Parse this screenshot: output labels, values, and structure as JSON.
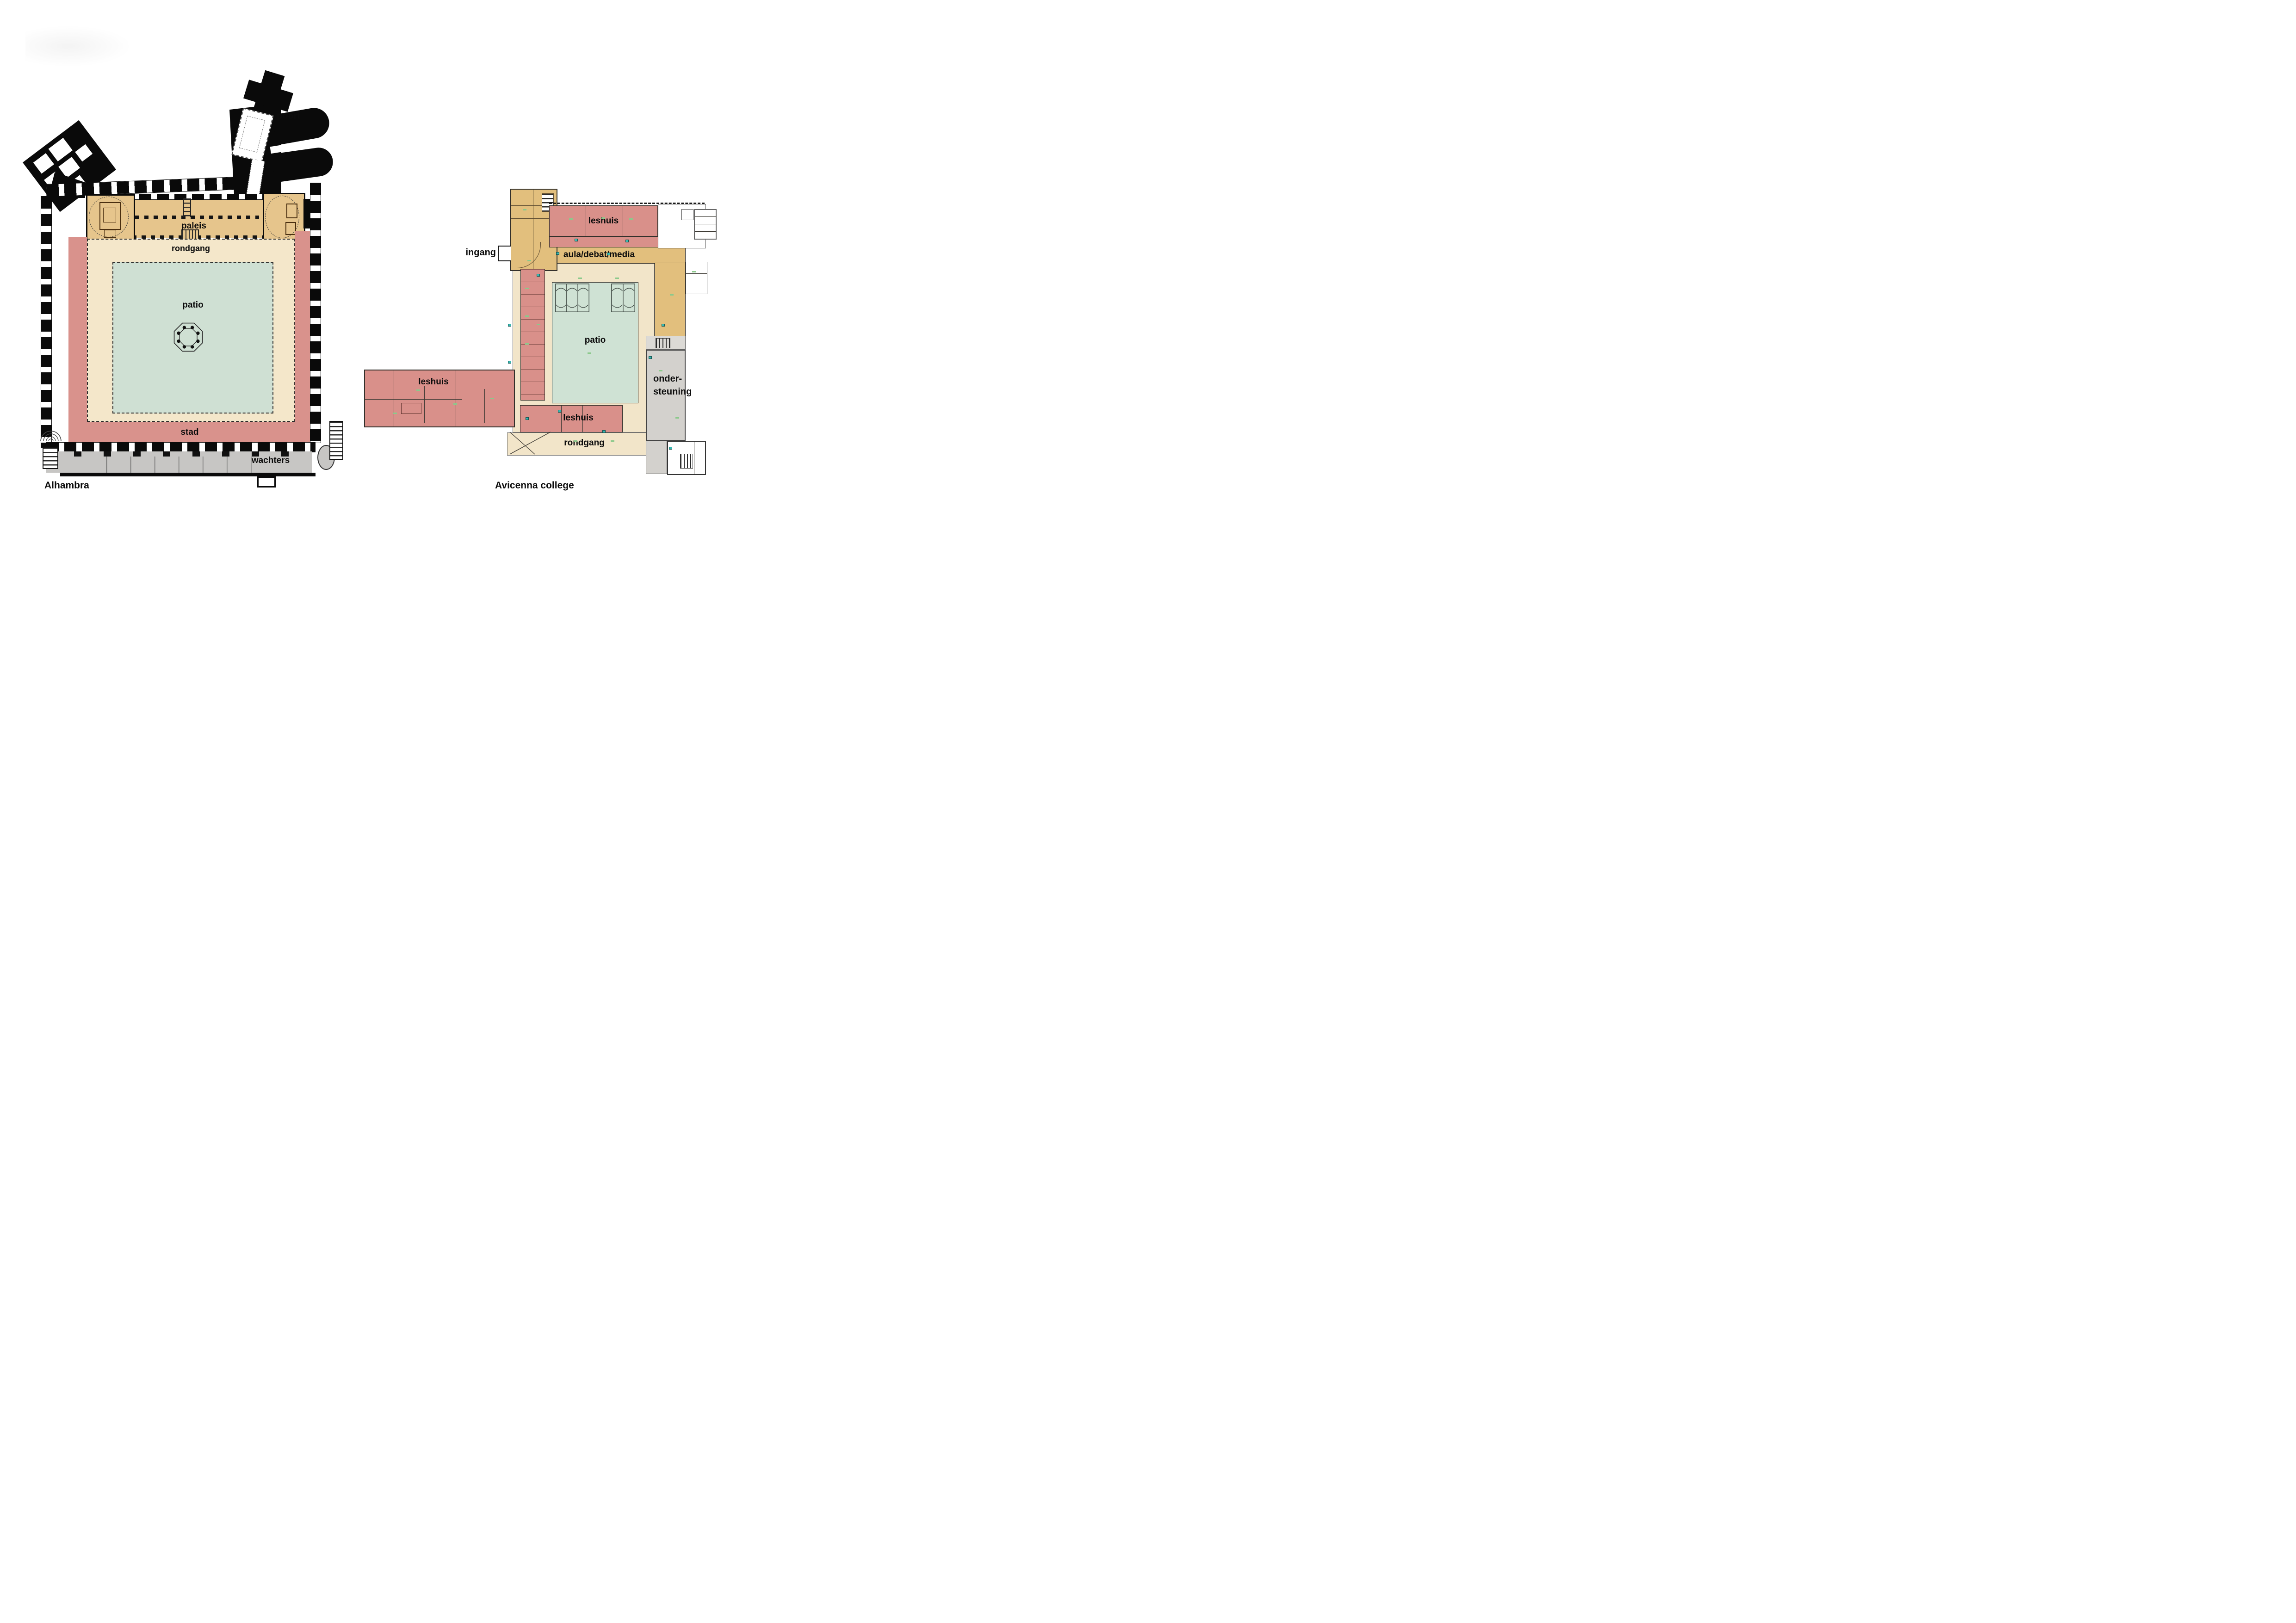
{
  "theme": {
    "colors": {
      "wall": "#0a0a0a",
      "paleis": "#e6c58c",
      "rondgang": "#f4e7ca",
      "patio": "#cfe0d3",
      "stad": "#d9928c",
      "wachters": "#c7c6c4",
      "gold": "#e2bf7d",
      "red": "#d9908a",
      "cream": "#f2e5c9",
      "patio2": "#cfe2d4",
      "grey": "#d3d1cd",
      "greytop": "#dcdad6",
      "line": "#33302b",
      "note": "#8bc98b",
      "cyan": "#38b8b2"
    }
  },
  "alhambra": {
    "title": "Alhambra",
    "labels": {
      "poort": "poort",
      "paleis": "paleis",
      "rondgang": "rondgang",
      "patio": "patio",
      "stad": "stad",
      "wachters": "wachters"
    }
  },
  "avicenna": {
    "title": "Avicenna college",
    "labels": {
      "ingang": "ingang",
      "leshuis_top": "leshuis",
      "aula": "aula/debat/media",
      "patio": "patio",
      "leshuis_left": "leshuis",
      "onder_line1": "onder-",
      "onder_line2": "steuning",
      "leshuis_bottom": "leshuis",
      "rondgang": "rondgang"
    }
  }
}
